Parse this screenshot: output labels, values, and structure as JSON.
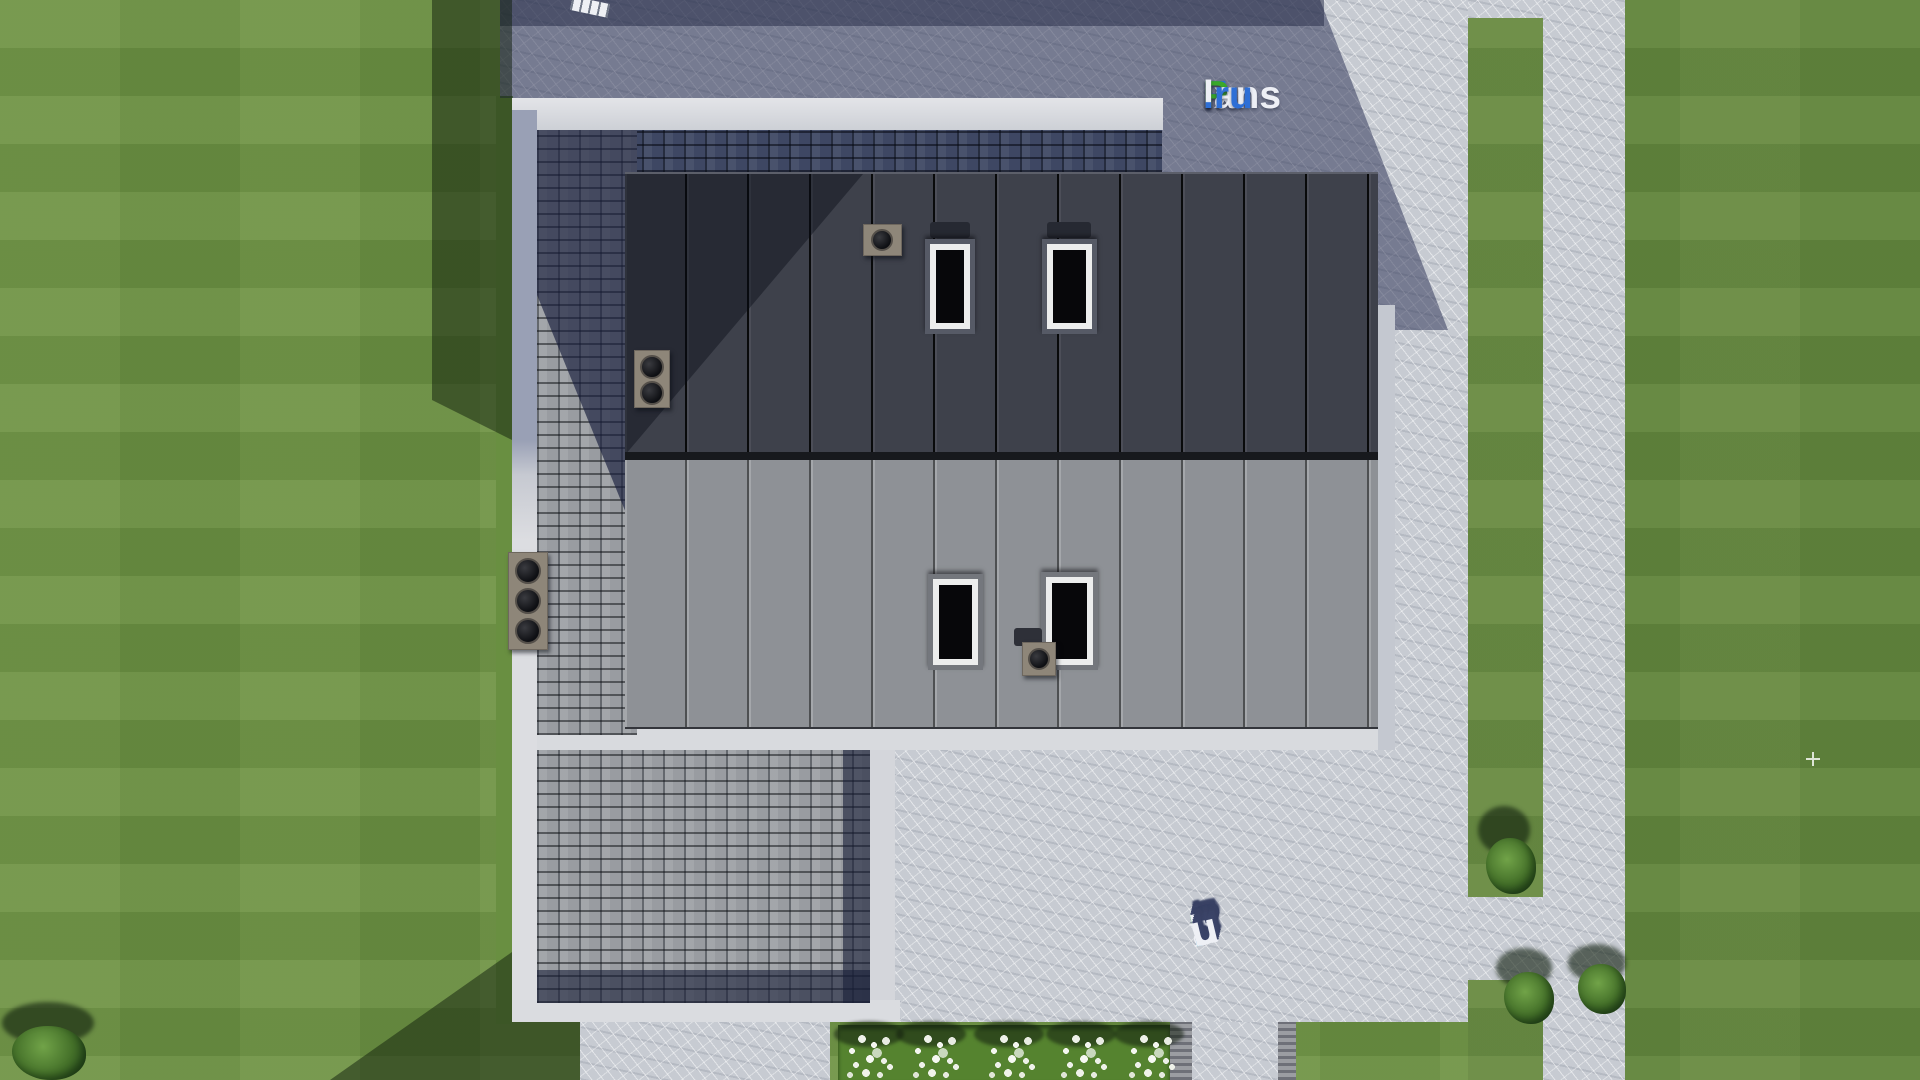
{
  "scene": {
    "type": "aerial-3d-render",
    "subject": "Top-down view of a modern flat-roof house with standing-seam roofing, shingle border roof, paved terrace, garden paths, lawn, bushes and a white flower bed"
  },
  "brand": {
    "name": "FixPlans.ru",
    "top_logo_parts": [
      {
        "text": "F",
        "color": "#2e6fd6"
      },
      {
        "text": "ix",
        "color": "#edeff5"
      },
      {
        "text": "P",
        "color": "#3aa82a"
      },
      {
        "text": "lans",
        "color": "#edeff5"
      },
      {
        "text": ".ru",
        "color": "#2e6fd6"
      }
    ],
    "ground_logo_letters": [
      {
        "text": "F",
        "color": "#2a9ae0"
      },
      {
        "text": "i",
        "color": "#5fc13a"
      },
      {
        "text": "x",
        "color": "#eef0f5"
      },
      {
        "text": "P",
        "color": "#5fc13a"
      },
      {
        "text": "l",
        "color": "#eef0f5"
      },
      {
        "text": "a",
        "color": "#eef0f5"
      },
      {
        "text": "n",
        "color": "#eef0f5"
      },
      {
        "text": "s",
        "color": "#eef0f5"
      },
      {
        "text": ".",
        "color": "#2a9ae0"
      },
      {
        "text": "r",
        "color": "#eef0f5"
      },
      {
        "text": "u",
        "color": "#eef0f5"
      }
    ]
  },
  "palette": {
    "grass": "#6d9244",
    "grass_shadow": "#2f4a26",
    "pavement": "#c7cbd2",
    "pavement_shadow": "#565e7e",
    "roof_dark": "#3e414b",
    "roof_light": "#8e9196",
    "shingle_lit": "#999ca1",
    "shingle_shadow": "#3e4763",
    "parapet_white": "#d8dade"
  },
  "house": {
    "roof_upper": "dark standing-seam metal",
    "roof_lower": "light grey standing-seam metal",
    "border_roof": "grey asphalt shingle",
    "skylight_count": 4,
    "roof_vent_count": 4
  },
  "landscape": {
    "flower_cluster_count": 5,
    "bush_count": 4,
    "paths": [
      "right garden path",
      "bottom walkway",
      "bottom path"
    ]
  }
}
